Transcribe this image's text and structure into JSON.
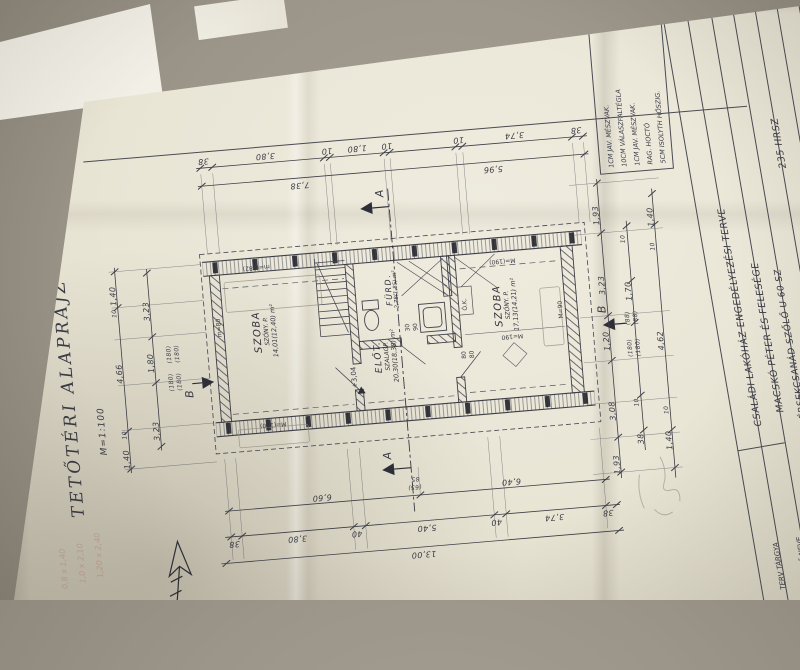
{
  "drawing_title": {
    "text": "TETŐTÉRI ALAPRAJZ",
    "scale": "M=1:100"
  },
  "rooms": [
    {
      "name": "SZOBA",
      "floor": "SZŐNY. P.",
      "area": "14,01(12,40) m²"
    },
    {
      "name": "FÜRD.",
      "floor": "",
      "area": "2,78(1,85) m²"
    },
    {
      "name": "ELŐT.",
      "floor": "SZALAGP.",
      "area": "20,30(18,38) m²"
    },
    {
      "name": "SZOBA",
      "floor": "SZŐNY. P.",
      "area": "17,13(14,21) m²"
    }
  ],
  "marks": {
    "level": "+3,04",
    "section_a": "A",
    "section_b": "B",
    "ok_label": "Ó.K."
  },
  "wall_labels": {
    "left_top": "m=(182)",
    "left_bottom": "M=(190)",
    "left_side": "m=80",
    "right_top": "M=(190)",
    "right_mid": "M=190",
    "right_side": "M=90",
    "pair_30": "30",
    "pair_90": "90",
    "pair_80a": "80",
    "pair_80b": "80"
  },
  "dims": {
    "top": [
      "38",
      "3,80",
      "10",
      "1,80",
      "10",
      "10",
      "3,74",
      "38"
    ],
    "top_totals": [
      "7,38",
      "5,96"
    ],
    "bottom_row1": [
      "6,60",
      "6,40"
    ],
    "bottom_row1_small": [
      "85",
      "(65)"
    ],
    "bottom_row2": [
      "38",
      "3,80",
      "40",
      "5,40",
      "40",
      "3,74",
      "38"
    ],
    "bottom_total": "13,00",
    "left_outer": [
      "1,40",
      "10",
      "4,66",
      "10",
      "1,40"
    ],
    "left_inner": [
      "3,23",
      "1,80",
      "3,23"
    ],
    "left_small": [
      "(180)",
      "(180)",
      "(180)",
      "(180)"
    ],
    "right_col1": [
      "1,93",
      "3,23",
      "1,20",
      "3,08",
      "1,93"
    ],
    "right_col2": [
      "10",
      "1,70",
      "(88)",
      "(88)",
      "(180)",
      "(180)",
      "10",
      "38"
    ],
    "right_col3": [
      "1,40",
      "10",
      "4,62",
      "10",
      "1,40"
    ]
  },
  "legend": {
    "lines": [
      "1CM JAV. MÉSZVAK.",
      "10CM VÁLASZFALTÉGLA",
      "1CM JAV. MÉSZVAK.",
      "RAG. HOCTÓ",
      "5CM ISOLYTH HŐSZIG."
    ]
  },
  "title_block": {
    "rows": [
      {
        "label": "TERV TÁRGYA",
        "value": "CSALÁDI LAKÓHÁZ ENGEDÉLYEZÉSI TERVE"
      },
      {
        "label": "ÉPÍTTETŐ NEVE",
        "value": "MACSKÓ PÉTER ÉS FELESÉGE"
      },
      {
        "label": "",
        "value": "ÉRSEKCSANÁD SZŐLŐ U 60 SZ"
      },
      {
        "label": "",
        "value": "235 HRSZ"
      },
      {
        "label": "",
        "value": "66"
      },
      {
        "label": "",
        "value": "73 SC"
      }
    ]
  },
  "handwriting": {
    "pink_notes": [
      "0,8 x 1,40",
      "1,0 x 2,10",
      "1,20 x 2,40"
    ],
    "signature": "N PÁL"
  }
}
